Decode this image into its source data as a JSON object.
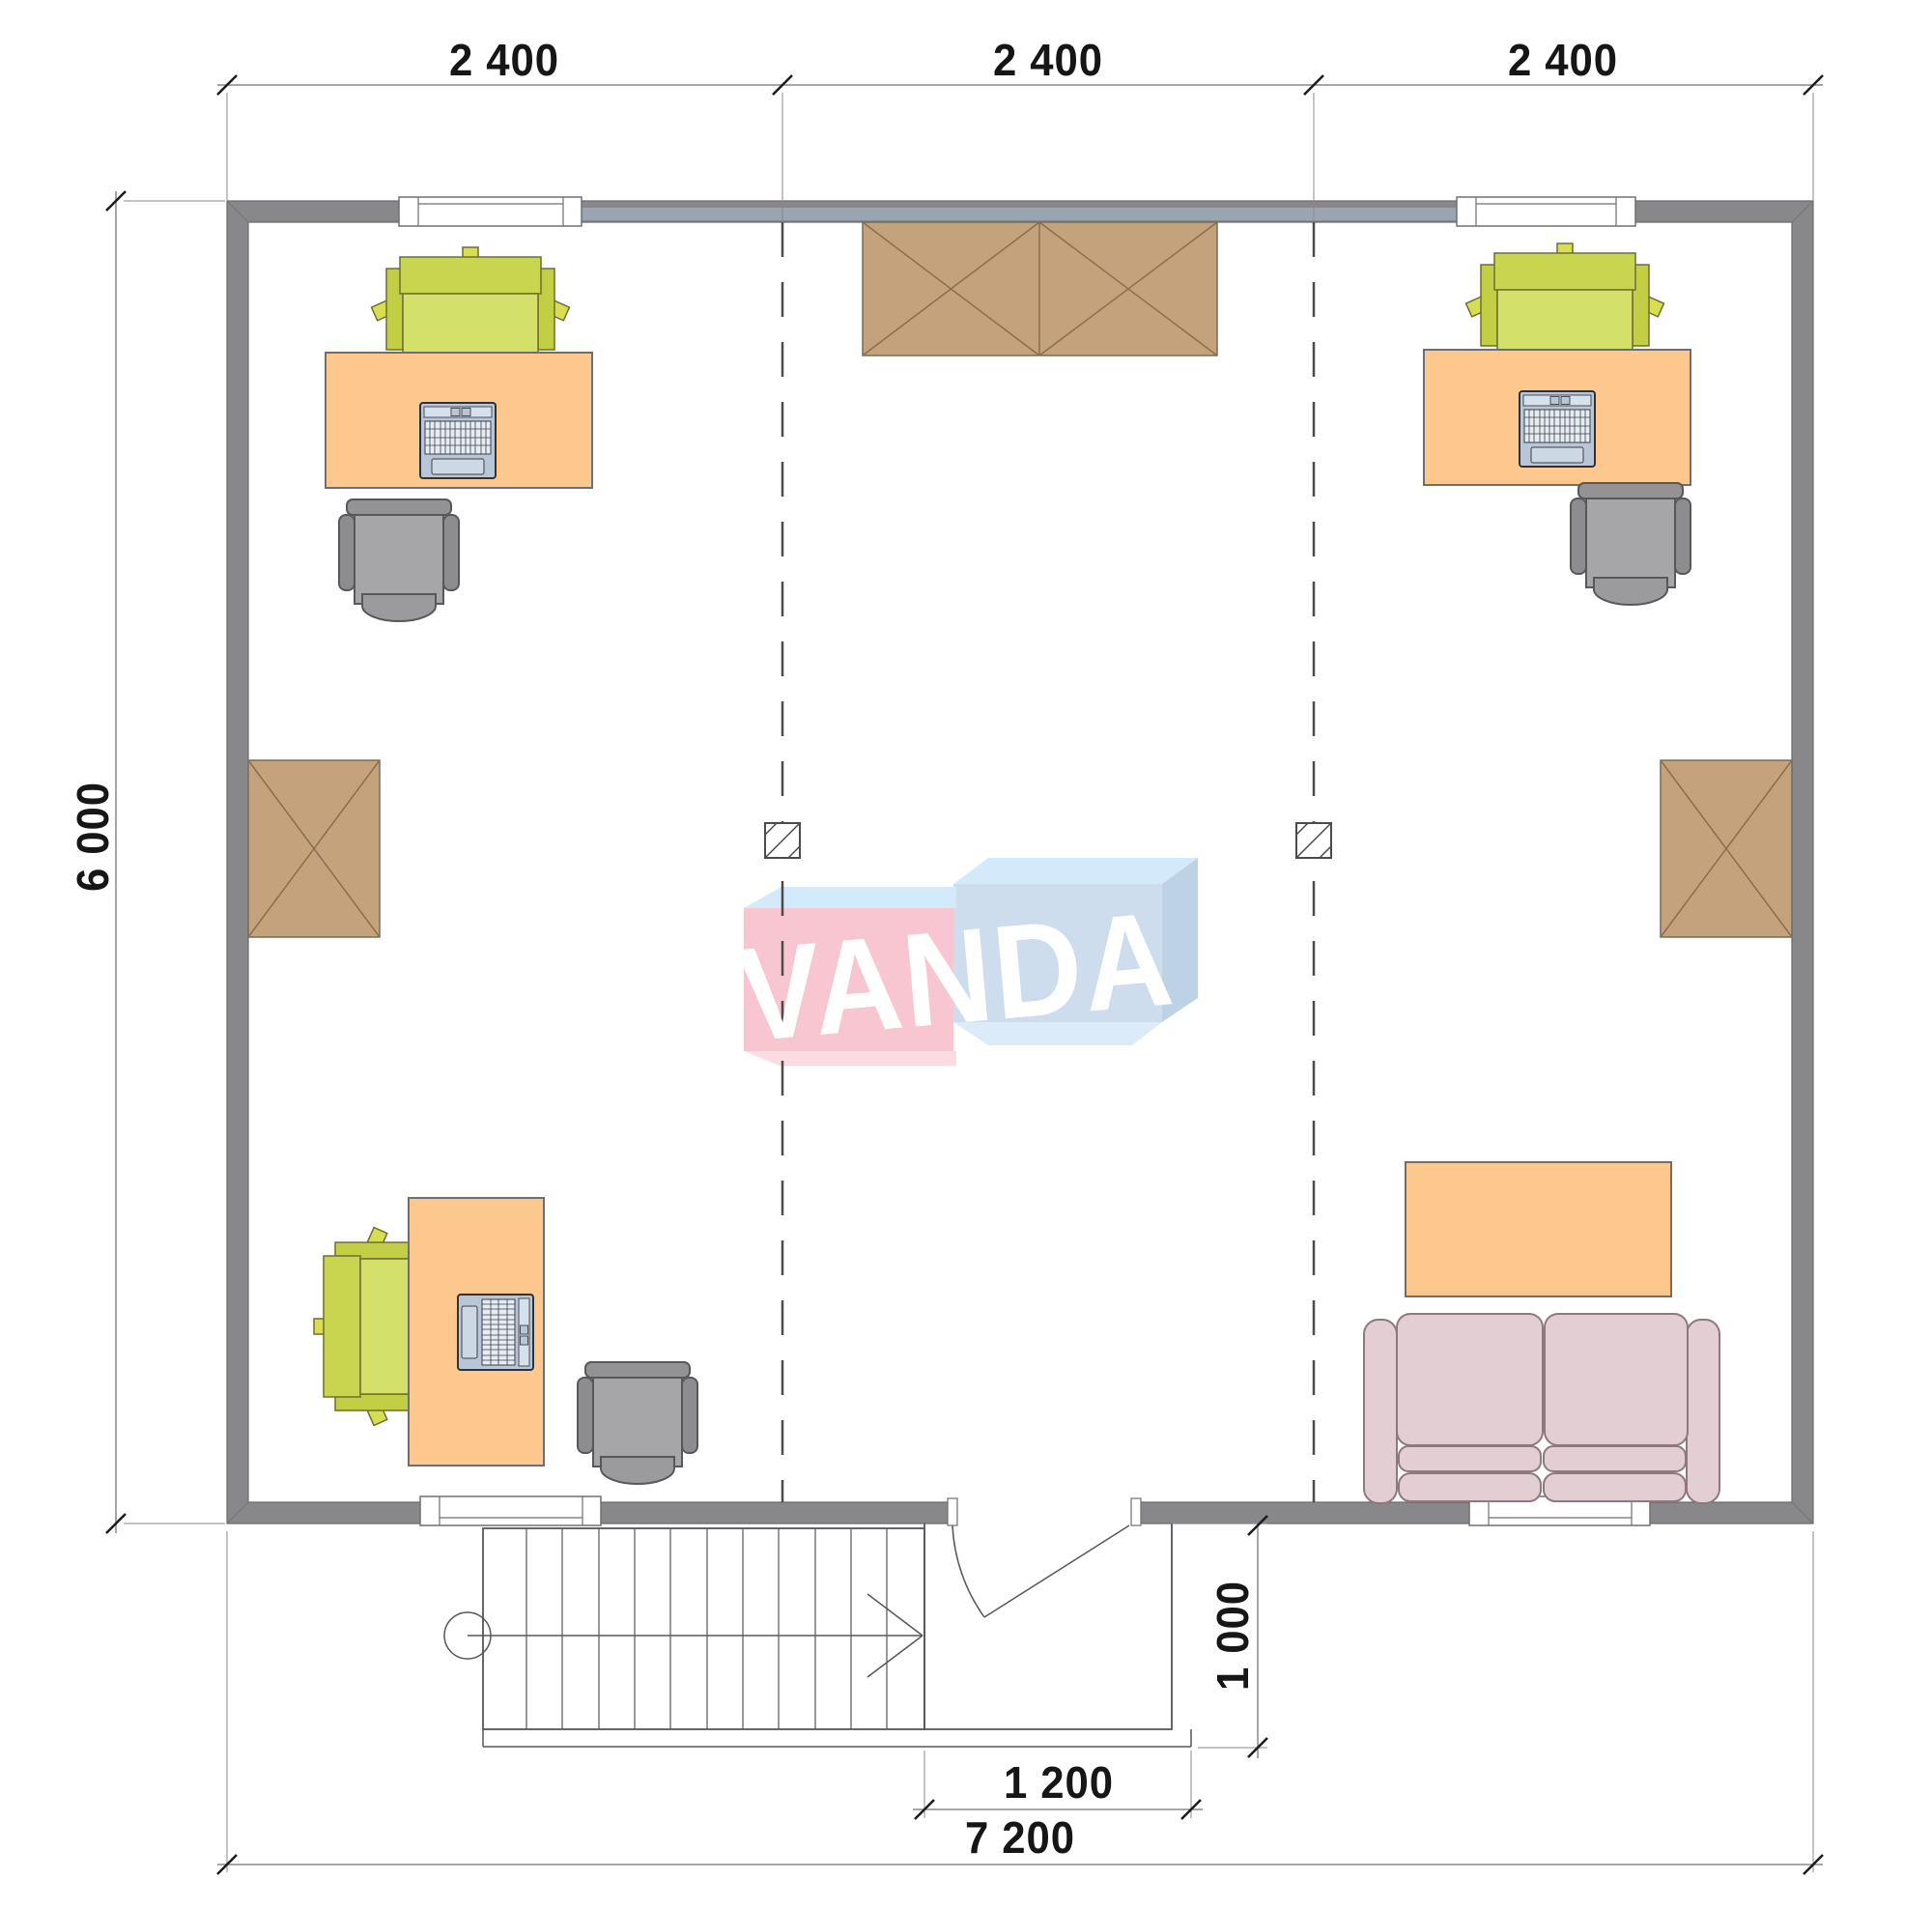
{
  "drawing": {
    "kind": "architectural floor plan, top view, office layout with stairs and entrance porch"
  },
  "dimensions": {
    "top": [
      "2 400",
      "2 400",
      "2 400"
    ],
    "left_height": "6 000",
    "entry_depth": "1 000",
    "entry_width": "1 200",
    "total_width": "7 200"
  },
  "watermark": {
    "text": "VANDA"
  },
  "colors": {
    "wall": "#88888b",
    "wall_lintel": "#9aa5b3",
    "desk_orange": "#fcc88d",
    "chair_lime": "#ccd95a",
    "office_chair_gray": "#a6a6a9",
    "cabinet_brown": "#c4a27c",
    "sofa_pink": "#e3ced4",
    "logo_pink": "#f8c6d0",
    "logo_blue": "#cdddee",
    "logo_sky": "#d3eafb",
    "line_dark": "#55565a"
  },
  "symbols": [
    "wardrobe-crossed-box",
    "wall-cabinet-crossed-box",
    "column-symbol",
    "desk-with-laptop",
    "task-chair",
    "office-swivel-chair",
    "two-seat-sofa",
    "coffee-table",
    "staircase-with-direction-arrow",
    "entrance-door-swing",
    "window",
    "section-dashed-line"
  ]
}
